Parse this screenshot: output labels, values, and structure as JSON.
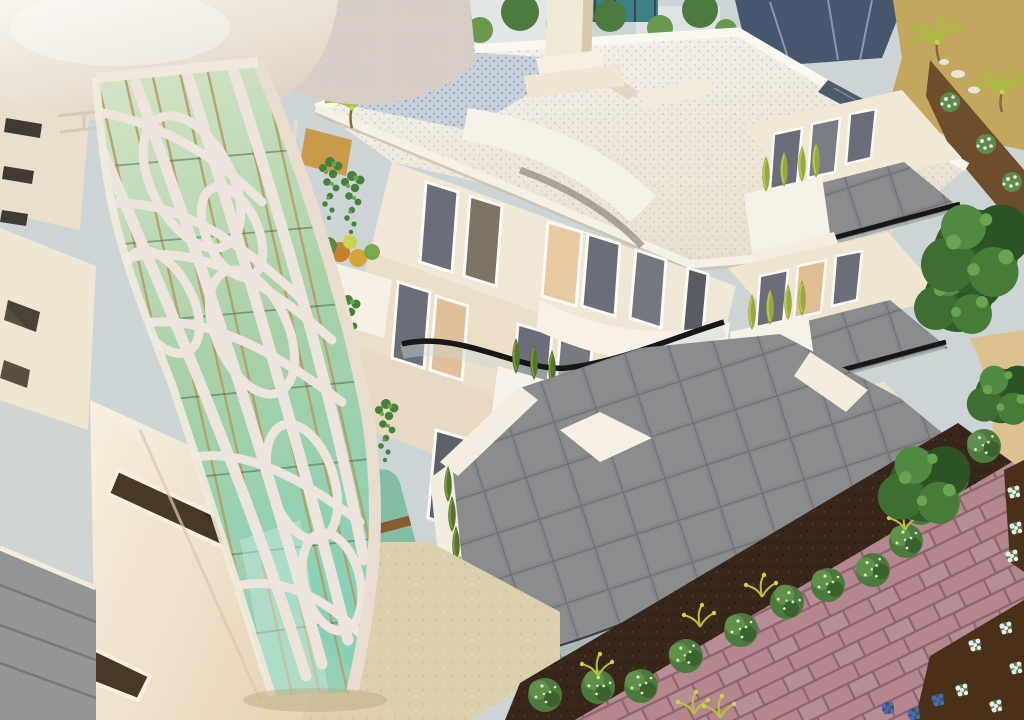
{
  "scene": {
    "type": "3d-architectural-render",
    "subject": "aerial view of a modern white apartment building with curved balconies and a perforated lattice tower",
    "lighting": "warm low sun from the lower left",
    "features": [
      "organic voronoi lattice screen over green glass tower",
      "smooth white rooftop canopy",
      "gravel-textured flat roof with elevator shaft",
      "curved glass balcony balustrades with black handrails",
      "white balcony planters with cypress and ivy",
      "slate tiled ground terraces",
      "garden row of round shrubs in dark soil",
      "pink brick paving and tan garden path",
      "white and blue flower beds",
      "neighboring roofs, palms and trees in background"
    ],
    "floors_visible": 3,
    "right_wing_balcony_levels": 3,
    "garden_shrub_count": 12
  },
  "palette": {
    "bg_band": "#ccd4d6",
    "bg_ground_tan": "#c3a75e",
    "neighbor_roof": "#46566e",
    "dirt_brown": "#6e4e2a",
    "canopy_white": "#f1ebe1",
    "curved_band": "#d9cec6",
    "navy_gap": "#2e3f52",
    "roof_white": "#f4f0e6",
    "parapet_white": "#faf7f0",
    "solar_dark": "#4d5a6a",
    "facade_upper": "#f1e7d6",
    "facade_mid": "#ecdfca",
    "facade_lower": "#e8dac2",
    "window_dark": "#6b6e78",
    "window_warm": "#e8c9a2",
    "frame_white": "#fbfaf6",
    "rail_black": "#17171a",
    "glass_band": "#ccd8d4",
    "lattice_white": "#ece4dd",
    "mullion_gold": "#b59a5e",
    "glass_top": "#d6e5c9",
    "glass_mid": "#a8d0a8",
    "glass_teal": "#8ad0b8",
    "slate_tile": "#85878a",
    "slate_grout": "#6e7073",
    "plaza_beige": "#dccfae",
    "soil_dark": "#39261a",
    "brick_mauve": "#b4868e",
    "brick_grout": "#8d646e",
    "path_tan": "#dbc28f",
    "bench_teal": "#83bda6",
    "bench_strap": "#8a5a30",
    "pouf_pink": "#c9a3bd",
    "bush_green": "#4c7a3e",
    "cypress_green": "#55742e",
    "cypress_yellow": "#97a83d",
    "ivy_green": "#47803a",
    "tree_dark": "#335c2c",
    "flower_white": "#e7ebf0",
    "flower_blue": "#4a67c0",
    "flower_yellow": "#cdd24e"
  }
}
